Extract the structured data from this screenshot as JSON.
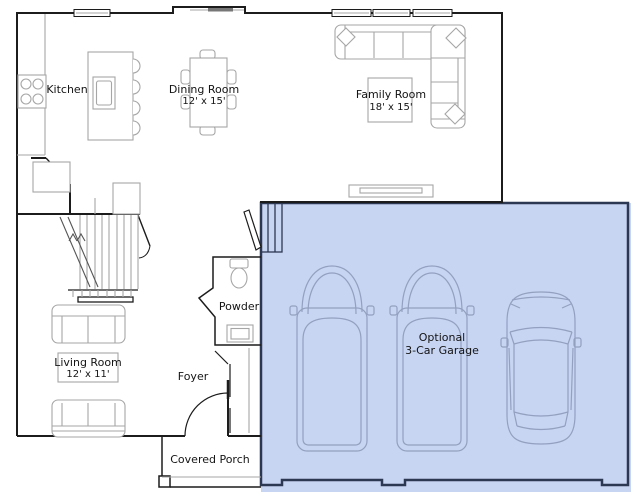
{
  "rooms": {
    "kitchen": {
      "label": "Kitchen"
    },
    "dining_room": {
      "label": "Dining Room",
      "dims": "12' x 15'"
    },
    "family_room": {
      "label": "Family Room",
      "dims": "18' x 15'"
    },
    "living_room": {
      "label": "Living Room",
      "dims": "12' x 11'"
    },
    "powder_room": {
      "label": "Powder"
    },
    "foyer": {
      "label": "Foyer"
    },
    "covered_porch": {
      "label": "Covered Porch"
    },
    "garage": {
      "label_line1": "Optional",
      "label_line2": "3-Car Garage"
    }
  },
  "colors": {
    "exterior_wall": "#1c1c1c",
    "furniture_line": "#a6a6a6",
    "garage_fill": "#c7d4f2",
    "garage_wall": "#2c3752",
    "vehicle_line": "#93a0bf",
    "text": "#141414",
    "background": "#ffffff"
  }
}
